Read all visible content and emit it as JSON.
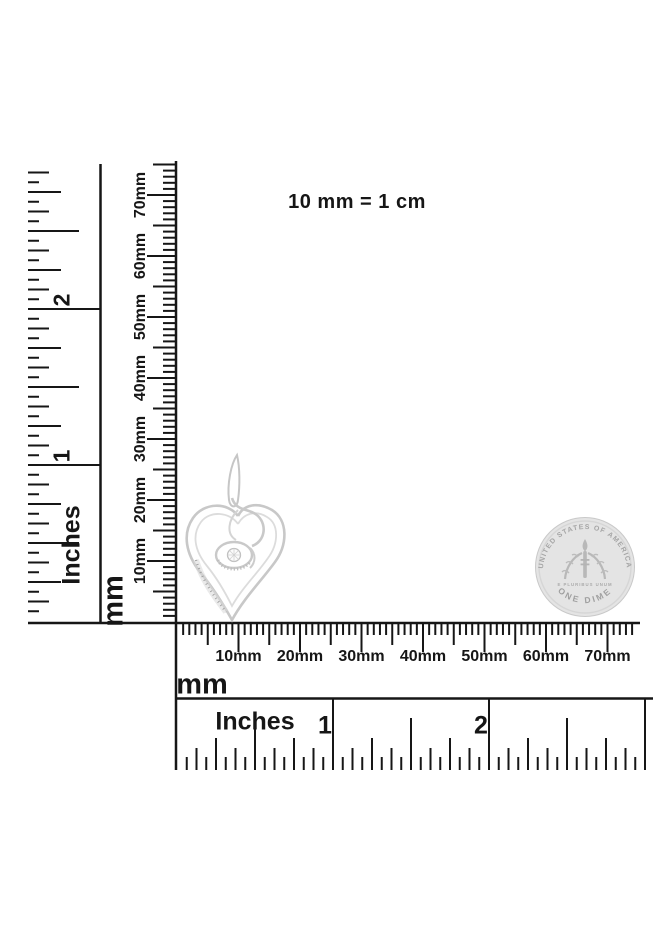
{
  "caption": "10 mm = 1 cm",
  "colors": {
    "ink": "#161616",
    "metal_light": "#d6d6d6",
    "coin_fill": "#e4e4e4",
    "coin_detail": "#a8a8a8",
    "background": "#ffffff"
  },
  "rulers": {
    "vertical_inches": {
      "unit_label": "Inches",
      "numbers": [
        "1",
        "2"
      ]
    },
    "vertical_mm": {
      "unit_label": "mm",
      "labels": [
        "10mm",
        "20mm",
        "30mm",
        "40mm",
        "50mm",
        "60mm",
        "70mm"
      ]
    },
    "horizontal_mm": {
      "unit_label": "mm",
      "labels": [
        "10mm",
        "20mm",
        "30mm",
        "40mm",
        "50mm",
        "60mm",
        "70mm"
      ]
    },
    "horizontal_inches": {
      "unit_label": "Inches",
      "numbers": [
        "1",
        "2"
      ]
    }
  },
  "coin": {
    "top_text": "UNITED STATES OF AMERICA",
    "bottom_text": "ONE DIME",
    "motto": "E PLURIBUS UNUM"
  }
}
